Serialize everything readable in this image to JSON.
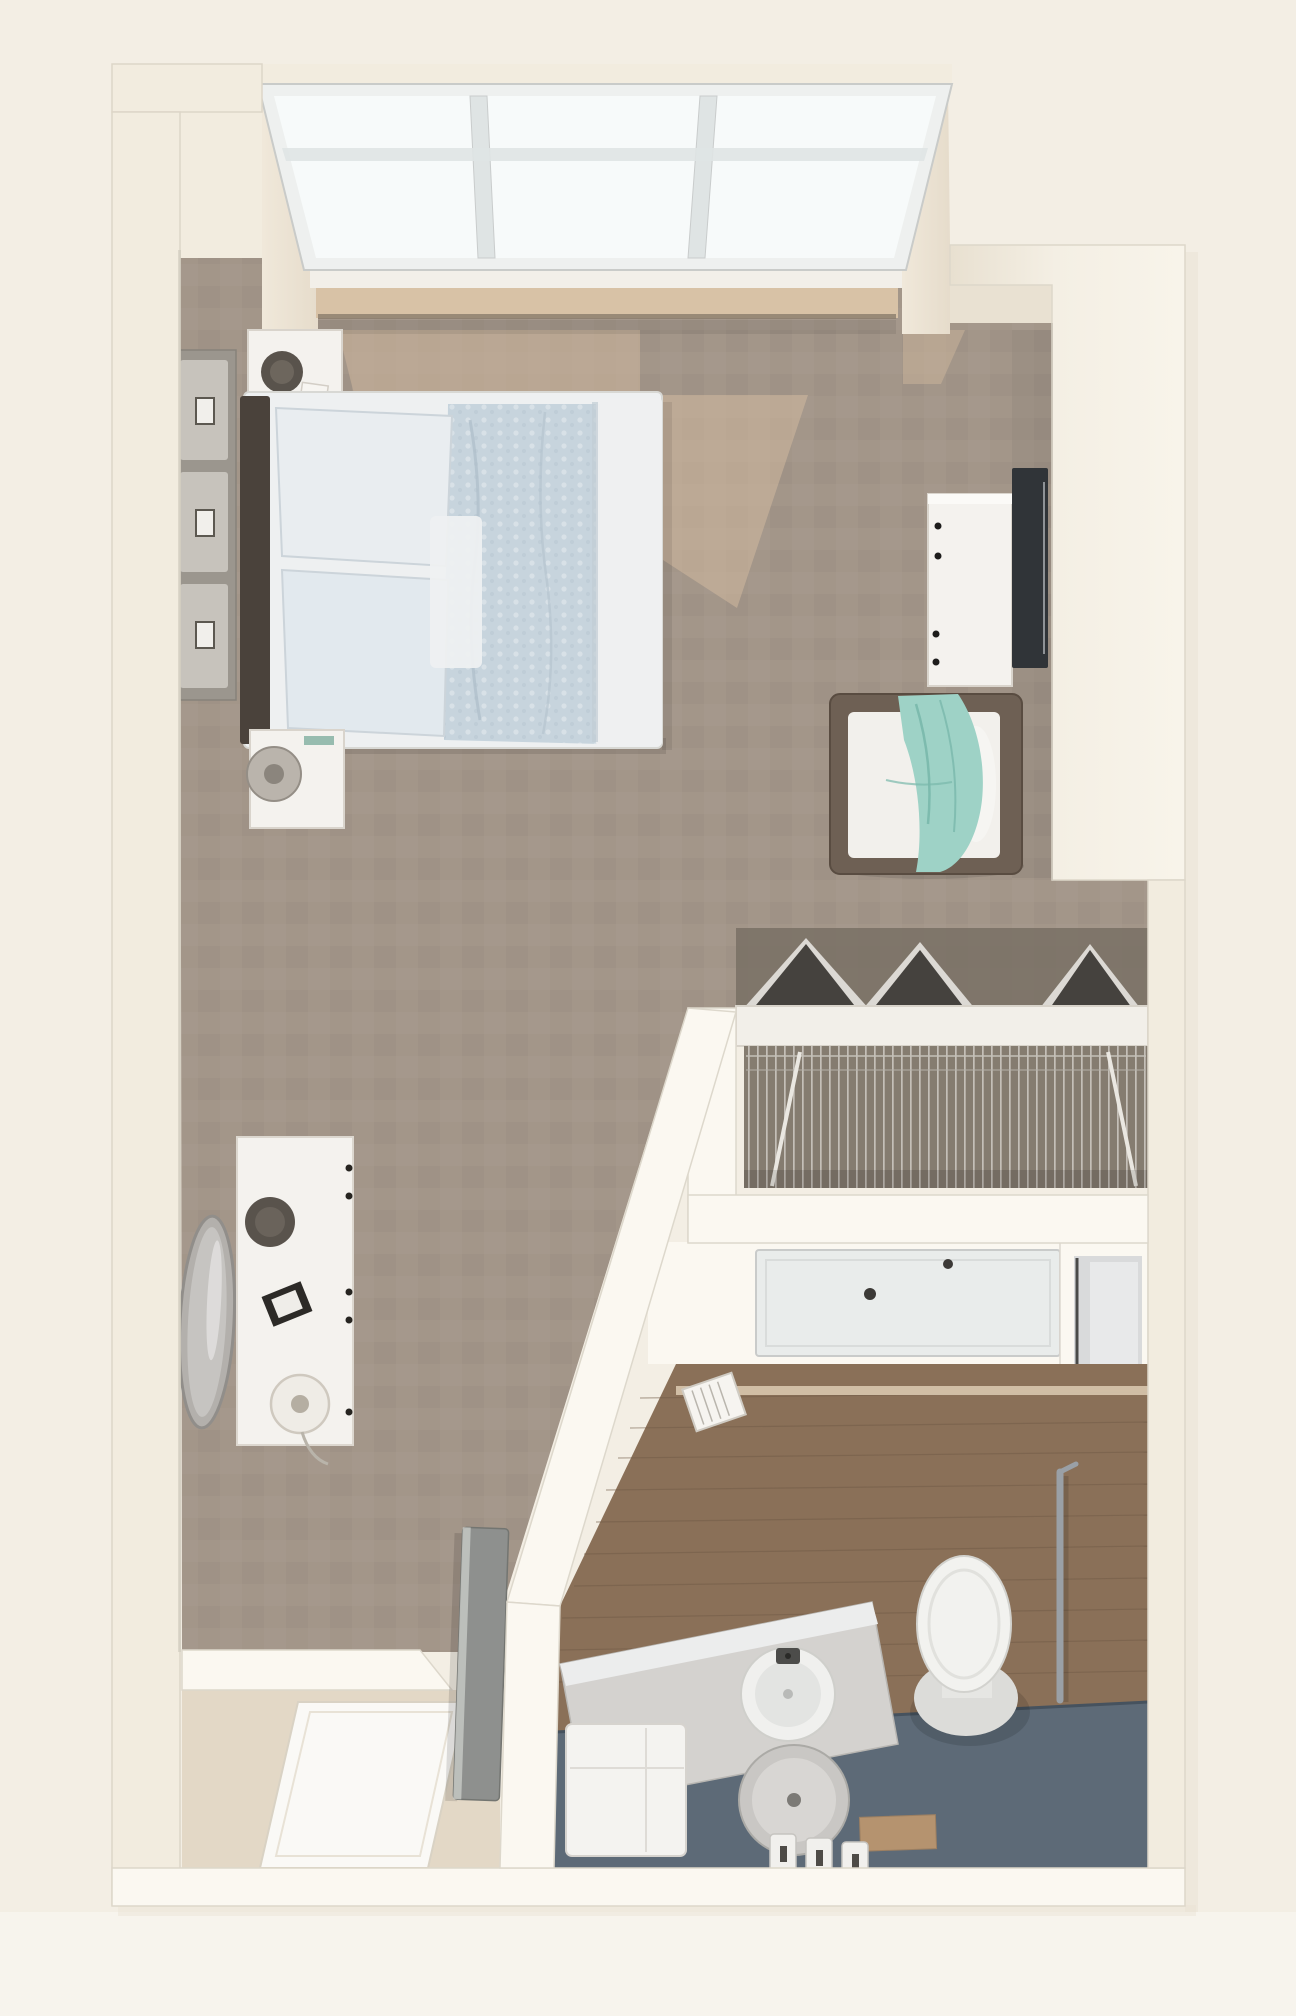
{
  "scene": {
    "kind": "3d-floor-plan-rendering",
    "unit_type": "studio-apartment",
    "view": "top-down-perspective"
  },
  "rooms": [
    {
      "name": "bedroom-living-area",
      "floor": "taupe-carpet"
    },
    {
      "name": "closet",
      "feature": "wire-shelving-and-hanging-clothes"
    },
    {
      "name": "bathroom",
      "floor": "wood-plank-and-slate"
    },
    {
      "name": "entry-vestibule",
      "floor": "tile-with-mat"
    }
  ],
  "furniture": [
    "bay-window",
    "bed",
    "headboard",
    "pillows",
    "duvet",
    "nightstand-upper",
    "nightstand-lower",
    "drawer-chest",
    "tv-console",
    "television",
    "armchair-with-teal-throw",
    "closet-wire-shelf",
    "hanging-clothes",
    "shower",
    "mirror-cabinet",
    "toilet",
    "grab-bar",
    "vanity-counter",
    "round-sink",
    "stool",
    "toiletry-canisters",
    "laundry-hamper",
    "wall-niche-basket",
    "dresser-desk",
    "round-mirror",
    "table-lamp",
    "entry-door",
    "door-mat"
  ],
  "colors": {
    "page_bg": "#f3eee4",
    "page_bg_light": "#f7f4ed",
    "wall_face": "#f2ecdf",
    "wall_bright": "#fbf8f1",
    "wall_shadow": "#e9e1d2",
    "wall_edge": "#d5cfc3",
    "carpet": "#a39689",
    "sun_patch": "#cdb69c",
    "sill_wood": "#d8c2a6",
    "sill_dark": "#8a7c6c",
    "window_glass": "#f7fafa",
    "window_frame": "#eef0ef",
    "mullion": "#dfe4e4",
    "headboard": "#4a423b",
    "bed_white": "#eef0f1",
    "pillow": "#e9edf0",
    "pillow2": "#e2e9ee",
    "duvet": "#c7d4dd",
    "furniture_white": "#f4f2ee",
    "chest_face": "#9b968e",
    "chest_drawer": "#c7c3bc",
    "tv_dark": "#303438",
    "wood_dark": "#6e6054",
    "cushion": "#f2f0ec",
    "teal": "#9ed2c6",
    "teal_dark": "#79b8ab",
    "closet_floor": "#7a7165",
    "clothes_dark": "#45423e",
    "clothes_light": "#dcd9d4",
    "shelf_white": "#f2efe9",
    "wire_bg": "#857c70",
    "shower_pan": "#e9eceb",
    "cabinet_gray": "#d9dadb",
    "wood_floor": "#8a7058",
    "wood_line": "#6f5a45",
    "threshold_light": "#d8c6ae",
    "slate": "#5d6a77",
    "rug_tan": "#b5936f",
    "toilet_white": "#f2f2ef",
    "metal": "#9aa0a6",
    "counter": "#d4d2cf",
    "stool_gray": "#c9c7c4",
    "tile_entry": "#e3d8c6",
    "mat_white": "#faf9f6",
    "door_gray": "#8e908e",
    "lamp_dark": "#59534c"
  }
}
